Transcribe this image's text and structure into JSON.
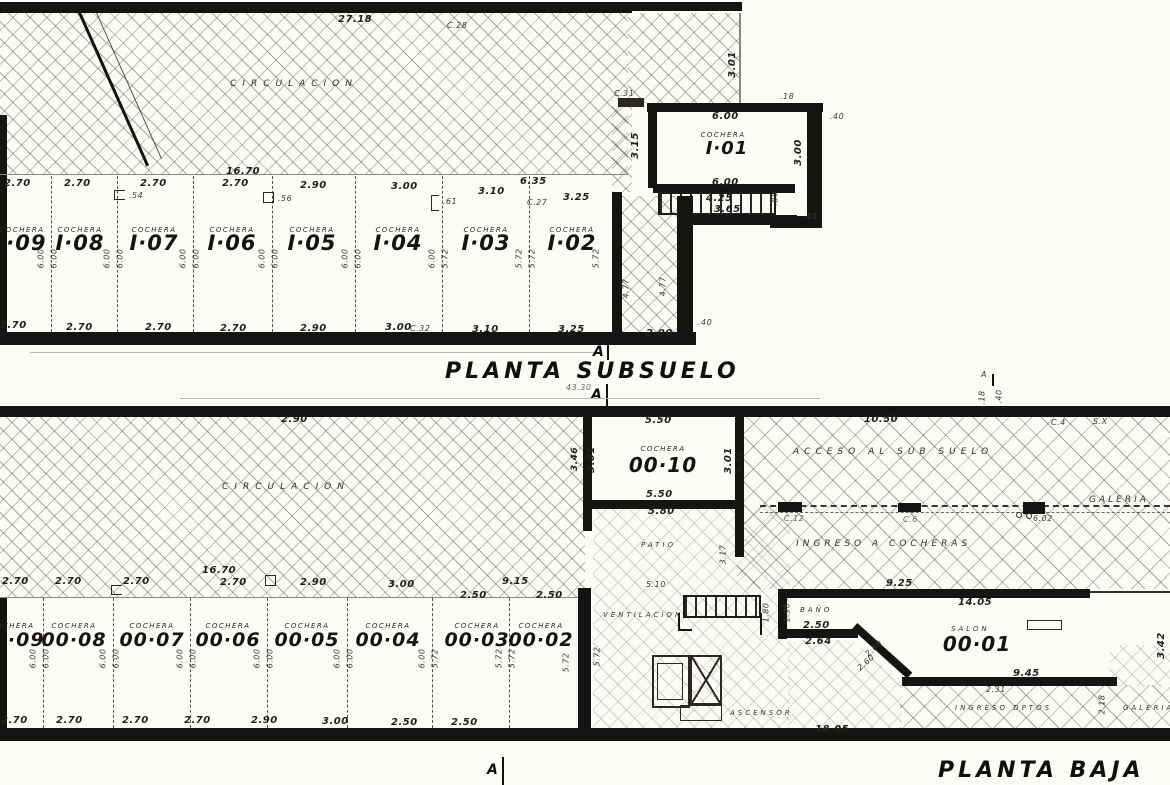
{
  "colors": {
    "ink": "#1c1a17",
    "paper": "#fcfbf7"
  },
  "sub": {
    "title": "PLANTA SUBSUELO",
    "section_a": "A",
    "overall_dim": "43.30",
    "room_circulacion": "CIRCULACION",
    "dim_2718": "27.18",
    "ref_c28": "C.28",
    "ref_c27": "C.27",
    "ref_c32": "C.32",
    "dim_1670": "16.70",
    "dim_635": "6.35",
    "top_dims": [
      "2.70",
      "2.70",
      "2.70",
      "2.70",
      "2.90",
      "3.00",
      "3.10",
      "3.25"
    ],
    "bot_dims": [
      "2.70",
      "2.70",
      "2.70",
      "2.70",
      "2.90",
      "3.00",
      "3.10",
      "3.25"
    ],
    "fixture_dims": [
      ".54",
      ".56",
      ".61"
    ],
    "cochera_label": "COCHERA",
    "stall_ids": [
      "I·09",
      "I·08",
      "I·07",
      "I·06",
      "I·05",
      "I·04",
      "I·03",
      "I·02"
    ],
    "depth_pairs": [
      [
        "6.00",
        "6.00"
      ],
      [
        "6.00",
        "6.00"
      ],
      [
        "6.00",
        "6.00"
      ],
      [
        "6.00",
        "6.00"
      ],
      [
        "6.00",
        "6.00"
      ],
      [
        "6.00",
        "5.72"
      ],
      [
        "5.72",
        "5.72"
      ]
    ],
    "depth_right": "5.72",
    "i01": {
      "id": "I·01",
      "dim_top": "6.00",
      "dim_bottom": "6.00",
      "dim_right": "3.00",
      "dim_left": "3.15",
      "stair_dims": [
        "4.25",
        "3.65"
      ],
      "stair_width": ".80",
      "wall_018": ".18",
      "wall_040_a": ".40",
      "wall_040_b": ".40",
      "wall_040_c": ".40",
      "hatch_dim": "3.01",
      "ref_c31": "C.31",
      "corridor_dims": [
        "4.77",
        "4.77"
      ],
      "corridor_bottom": "2.00"
    }
  },
  "baja": {
    "title": "PLANTA BAJA",
    "section_a": "A",
    "marker_a_small": "A",
    "marker_018": ".18",
    "marker_040": ".40",
    "room_circulacion": "CIRCULACION",
    "room_acceso": "ACCESO AL SUB SUELO",
    "room_galeria": "GALERIA",
    "room_galeria2": "GALERIA",
    "room_ingreso_cocheras": "INGRESO A COCHERAS",
    "room_ingreso_dptos": "INGRESO DPTOS",
    "room_patio": "PATIO",
    "room_ventilacion": "VENTILACION",
    "room_ascensor": "ASCENSOR",
    "dim_290": "2.90",
    "dim_1050": "10.50",
    "ref_c4": "C.4",
    "ref_sx": "S.X",
    "ref_c12": "C.12",
    "ref_c6": "C.6",
    "dim_602": "6.02",
    "dim_510": "5.10",
    "dim_317": "3.17",
    "dim_1805": "18.05",
    "dim_1670": "16.70",
    "dim_915": "9.15",
    "top_dims": [
      "2.70",
      "2.70",
      "2.70",
      "2.70",
      "2.90",
      "3.00",
      "2.50",
      "2.50"
    ],
    "bot_dims": [
      "2.70",
      "2.70",
      "2.70",
      "2.70",
      "2.90",
      "3.00",
      "2.50",
      "2.50"
    ],
    "cochera_label": "COCHERA",
    "stall_ids": [
      "00·09",
      "00·08",
      "00·07",
      "00·06",
      "00·05",
      "00·04",
      "00·03",
      "00·02"
    ],
    "depth_pairs": [
      [
        "6.00",
        "6.00"
      ],
      [
        "6.00",
        "6.00"
      ],
      [
        "6.00",
        "6.00"
      ],
      [
        "6.00",
        "6.00"
      ],
      [
        "6.00",
        "6.00"
      ],
      [
        "6.00",
        "5.72"
      ],
      [
        "5.72",
        "5.72"
      ]
    ],
    "depth_right": "5.72",
    "depth_right2": "5.72",
    "c10": {
      "id": "00·10",
      "dim_top": "5.50",
      "dim_bottom": "5.50",
      "dim_below": "5.80",
      "dim_side_l": "3.01",
      "dim_side_r": "3.01",
      "dim_out_l": "3.46",
      "dim_out_r": "3.46"
    },
    "c01": {
      "room_salon": "SALON",
      "id": "00·01",
      "room_bano": "BAÑO",
      "dim_925": "9.25",
      "dim_1405": "14.05",
      "dim_190": "1.90",
      "dim_180": "1.80",
      "dim_250": "2.50",
      "dim_264": "2.64",
      "dim_260a": "2.60",
      "dim_260b": "2.60",
      "dim_945": "9.45",
      "dim_231": "2.31",
      "dim_342": "3.42",
      "dim_218": "2.18"
    }
  }
}
